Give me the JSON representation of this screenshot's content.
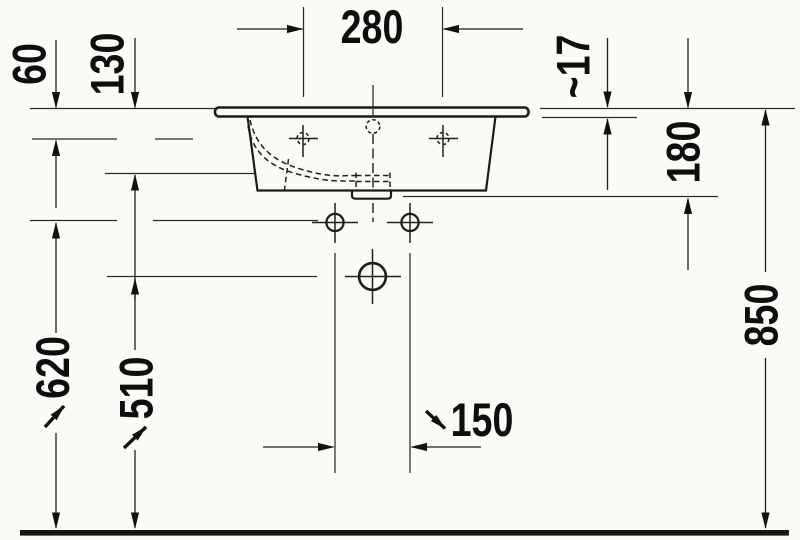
{
  "drawing": {
    "subject": "Washbasin installation technical drawing, front elevation with mounting dimensions",
    "colors": {
      "line": "#1b1b1b",
      "background": "#fafaf7",
      "text": "#0e0e0e"
    }
  },
  "dimensions": {
    "tap_hole_spacing": {
      "label": "280"
    },
    "rim_to_faucet_axis": {
      "label": "60"
    },
    "bowl_depth": {
      "label": "130"
    },
    "rim_thickness": {
      "label": "~17"
    },
    "basin_body_height": {
      "label": "180"
    },
    "rim_height_above_floor": {
      "label": "850"
    },
    "fixing_hole_height": {
      "label": "620"
    },
    "drain_outlet_height": {
      "label": "510"
    },
    "fixing_hole_spacing": {
      "label": "150"
    }
  }
}
